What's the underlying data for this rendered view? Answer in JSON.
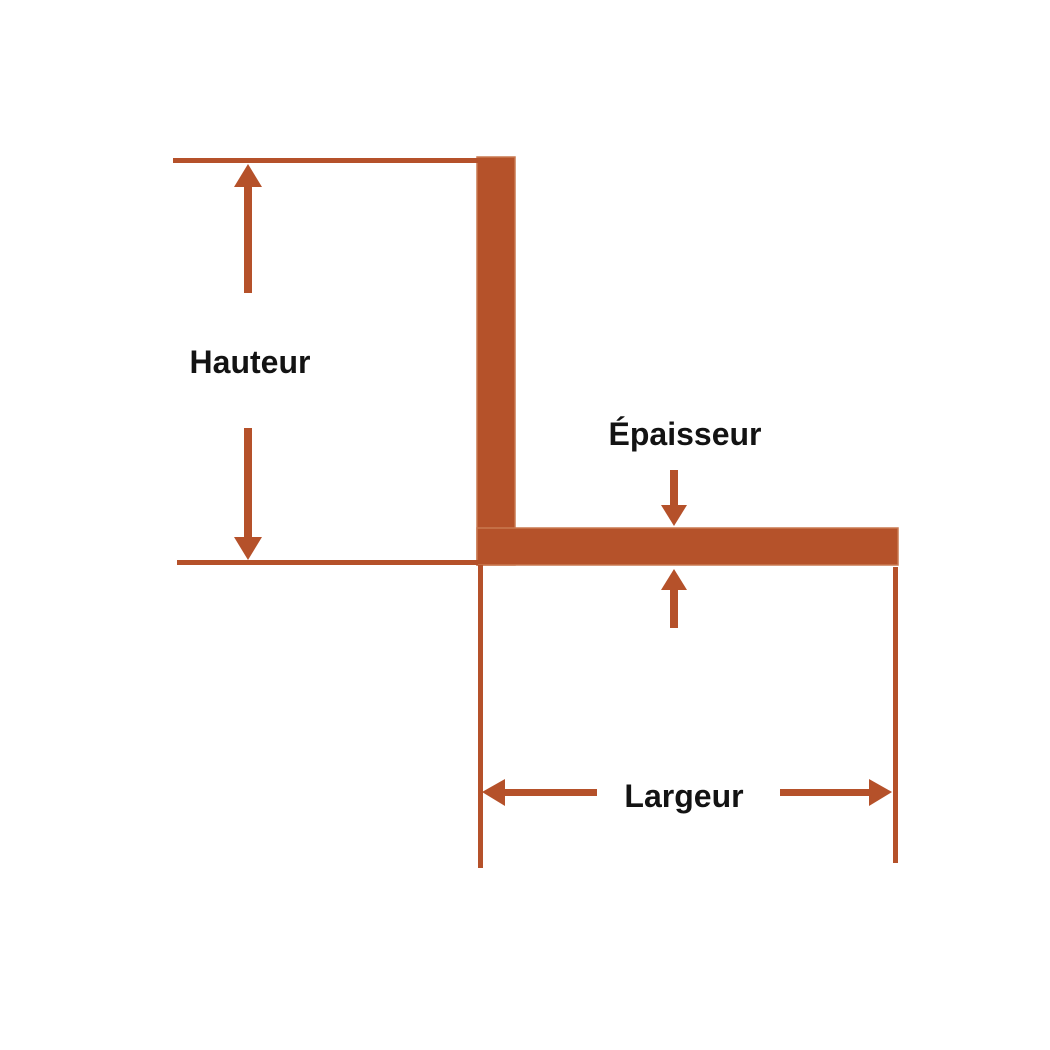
{
  "diagram": {
    "kind": "technical-dimension-diagram",
    "shape": "L-angle-profile",
    "labels": {
      "height": "Hauteur",
      "thickness": "Épaisseur",
      "width": "Largeur"
    },
    "colors": {
      "background": "#ffffff",
      "shape_fill": "#b5522a",
      "shape_stroke": "#c97950",
      "dimension_line": "#b5512a",
      "label_text": "#131313"
    }
  }
}
